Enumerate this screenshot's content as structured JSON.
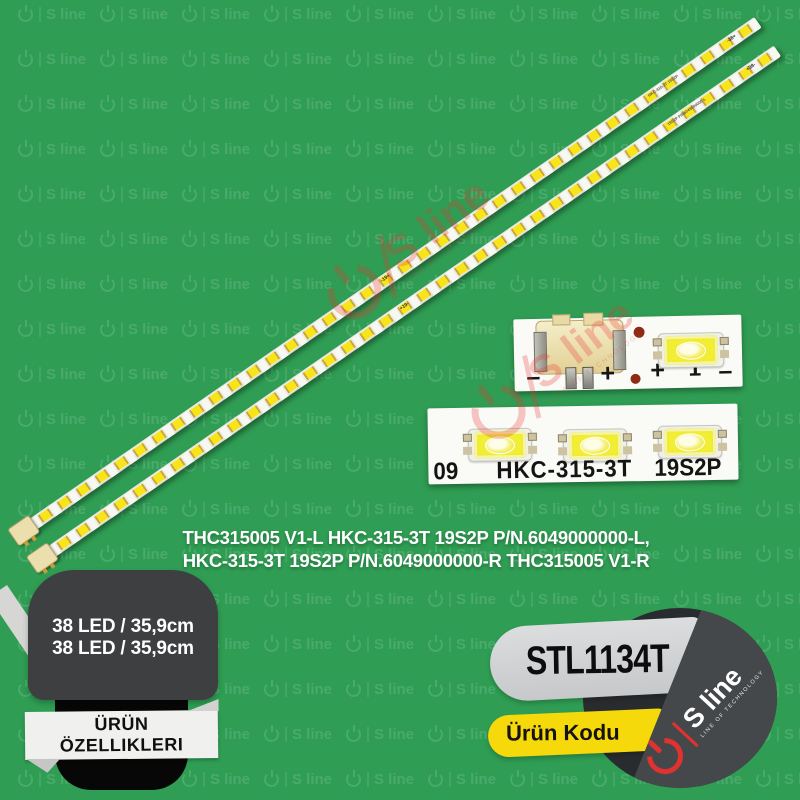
{
  "background": {
    "color": "#2f9d53",
    "watermark_label": "S line"
  },
  "red_watermark": {
    "label": "S line",
    "sub": "LINE OF TECHNOLOGY",
    "color": "#e93535"
  },
  "strips": {
    "led_count": 38,
    "strip1": {
      "mid_label": "-19+",
      "part_label": "HKC-315-3T 19S2P",
      "end_label": "-38+"
    },
    "strip2": {
      "mid_label": "+19-",
      "part_label": "19S2P P/N6049000000-L",
      "end_label": "+38-"
    }
  },
  "closeups": {
    "top": {
      "marks": [
        "–",
        "+",
        "+",
        "1",
        "–"
      ]
    },
    "bottom": {
      "left_text": "09",
      "center_text": "HKC-315-3T",
      "right_text": "19S2P"
    }
  },
  "description": {
    "line1": "THC315005 V1-L HKC-315-3T 19S2P P/N.6049000000-L,",
    "line2": "HKC-315-3T 19S2P P/N.6049000000-R THC315005 V1-R"
  },
  "features_badge": {
    "line1": "38 LED / 35,9cm",
    "line2": "38 LED / 35,9cm",
    "ribbon_line1": "ÜRÜN",
    "ribbon_line2": "ÖZELLIKLERI"
  },
  "code_badge": {
    "code": "STL1134T",
    "label": "Ürün Kodu",
    "logo_text": "S line",
    "logo_sub": "LINE OF TECHNOLOGY",
    "banner_color": "#d5d6d8",
    "label_bg": "#f6d90a",
    "circle_dark": "#292c2e",
    "circle_light": "#45484b",
    "logo_red": "#e23230"
  }
}
